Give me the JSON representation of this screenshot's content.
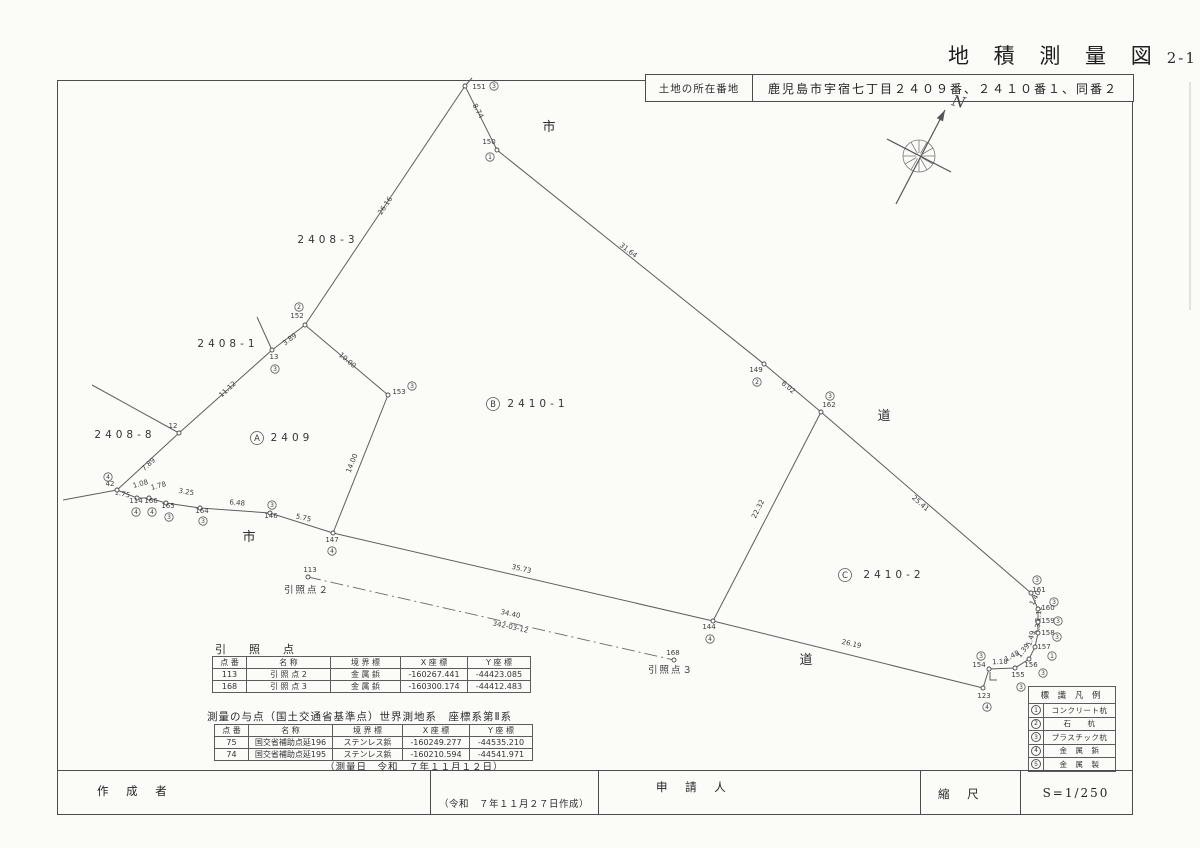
{
  "title": {
    "main": "地 積 測 量 図",
    "sheet": "2-1"
  },
  "address_box": {
    "label": "土地の所在番地",
    "value": "鹿児島市宇宿七丁目２４０９番、２４１０番１、同番２"
  },
  "compass": {
    "cx": 919,
    "cy": 156,
    "r": 16,
    "spokes": 12,
    "arrow": [
      [
        896,
        204
      ],
      [
        945,
        110
      ]
    ],
    "cross": [
      [
        887,
        139
      ],
      [
        951,
        172
      ]
    ],
    "label": "N",
    "lx": 951,
    "ly": 105
  },
  "map": {
    "road_labels": [
      {
        "t": "市",
        "x": 549,
        "y": 131
      },
      {
        "t": "市",
        "x": 249,
        "y": 541
      },
      {
        "t": "道",
        "x": 884,
        "y": 420
      },
      {
        "t": "道",
        "x": 806,
        "y": 664
      }
    ],
    "parcel_labels": [
      {
        "t": "2408-3",
        "x": 328,
        "y": 243
      },
      {
        "t": "2408-1",
        "x": 228,
        "y": 347
      },
      {
        "t": "2408-8",
        "x": 125,
        "y": 438
      },
      {
        "t": "2409",
        "x": 292,
        "y": 441,
        "letter": "A",
        "cx": 257,
        "cy": 438
      },
      {
        "t": "2410-1",
        "x": 538,
        "y": 407,
        "letter": "B",
        "cx": 493,
        "cy": 404
      },
      {
        "t": "2410-2",
        "x": 894,
        "y": 578,
        "letter": "C",
        "cx": 845,
        "cy": 575
      }
    ],
    "ref_labels": [
      {
        "t": "引照点２",
        "x": 307,
        "y": 593
      },
      {
        "t": "引照点３",
        "x": 671,
        "y": 673
      }
    ],
    "lines": [
      [
        [
          472,
          78
        ],
        [
          465,
          86
        ]
      ],
      [
        [
          465,
          86
        ],
        [
          497,
          150
        ]
      ],
      [
        [
          497,
          150
        ],
        [
          764,
          364
        ]
      ],
      [
        [
          764,
          364
        ],
        [
          821,
          412
        ]
      ],
      [
        [
          821,
          412
        ],
        [
          1031,
          593
        ]
      ],
      [
        [
          1031,
          593
        ],
        [
          1038,
          609
        ],
        [
          1038,
          622
        ],
        [
          1038,
          633
        ],
        [
          1035,
          647
        ],
        [
          1029,
          659
        ],
        [
          1015,
          668
        ],
        [
          989,
          669
        ]
      ],
      [
        [
          989,
          669
        ],
        [
          983,
          688
        ]
      ],
      [
        [
          983,
          688
        ],
        [
          713,
          621
        ]
      ],
      [
        [
          713,
          621
        ],
        [
          333,
          533
        ]
      ],
      [
        [
          333,
          533
        ],
        [
          270,
          513
        ],
        [
          200,
          508
        ],
        [
          166,
          503
        ],
        [
          149,
          498
        ],
        [
          137,
          498
        ],
        [
          117,
          490
        ]
      ],
      [
        [
          117,
          490
        ],
        [
          63,
          500
        ]
      ],
      [
        [
          117,
          490
        ],
        [
          179,
          433
        ]
      ],
      [
        [
          179,
          433
        ],
        [
          92,
          385
        ]
      ],
      [
        [
          179,
          433
        ],
        [
          272,
          350
        ]
      ],
      [
        [
          272,
          350
        ],
        [
          305,
          325
        ]
      ],
      [
        [
          272,
          350
        ],
        [
          257,
          317
        ]
      ],
      [
        [
          305,
          325
        ],
        [
          465,
          86
        ]
      ],
      [
        [
          305,
          325
        ],
        [
          388,
          395
        ]
      ],
      [
        [
          388,
          395
        ],
        [
          333,
          533
        ]
      ],
      [
        [
          821,
          412
        ],
        [
          713,
          621
        ]
      ],
      [
        [
          990,
          672
        ],
        [
          990,
          680
        ],
        [
          997,
          680
        ]
      ]
    ],
    "dashed_lines": [
      [
        [
          308,
          577
        ],
        [
          674,
          660
        ]
      ]
    ],
    "faint_lines": [
      [
        [
          1190,
          82
        ],
        [
          1190,
          310
        ]
      ]
    ],
    "length_labels": [
      {
        "t": "8.74",
        "x": 476,
        "y": 112,
        "r": 62
      },
      {
        "t": "26.16",
        "x": 387,
        "y": 207,
        "r": -56
      },
      {
        "t": "31.64",
        "x": 627,
        "y": 252,
        "r": 38
      },
      {
        "t": "6.02",
        "x": 787,
        "y": 389,
        "r": 40
      },
      {
        "t": "25.41",
        "x": 919,
        "y": 505,
        "r": 41
      },
      {
        "t": "22.32",
        "x": 760,
        "y": 510,
        "r": -63
      },
      {
        "t": "10.00",
        "x": 346,
        "y": 362,
        "r": 40
      },
      {
        "t": "3.89",
        "x": 291,
        "y": 341,
        "r": -37
      },
      {
        "t": "11.12",
        "x": 229,
        "y": 391,
        "r": -42
      },
      {
        "t": "7.89",
        "x": 150,
        "y": 466,
        "r": -43
      },
      {
        "t": "14.00",
        "x": 354,
        "y": 464,
        "r": -68
      },
      {
        "t": "1.75",
        "x": 122,
        "y": 496,
        "r": 12
      },
      {
        "t": "1.08",
        "x": 141,
        "y": 486,
        "r": -15
      },
      {
        "t": "1.78",
        "x": 159,
        "y": 488,
        "r": -15
      },
      {
        "t": "3.25",
        "x": 186,
        "y": 494,
        "r": 9
      },
      {
        "t": "6.48",
        "x": 237,
        "y": 505,
        "r": 5
      },
      {
        "t": "5.75",
        "x": 303,
        "y": 520,
        "r": 13
      },
      {
        "t": "35.73",
        "x": 521,
        "y": 571,
        "r": 13
      },
      {
        "t": "26.19",
        "x": 851,
        "y": 646,
        "r": 13
      },
      {
        "t": "34.40",
        "x": 510,
        "y": 616,
        "r": 12
      },
      {
        "t": "342-03-12",
        "x": 510,
        "y": 629,
        "r": 12
      },
      {
        "t": "1.18",
        "x": 1000,
        "y": 664,
        "r": -2
      },
      {
        "t": "1.48",
        "x": 1013,
        "y": 658,
        "r": -28
      },
      {
        "t": "1.39",
        "x": 1025,
        "y": 652,
        "r": -52
      },
      {
        "t": "1.49",
        "x": 1033,
        "y": 639,
        "r": -74
      },
      {
        "t": "0.35",
        "x": 1040,
        "y": 627,
        "r": -86
      },
      {
        "t": "1.12",
        "x": 1041,
        "y": 614,
        "r": -84
      },
      {
        "t": "1.40",
        "x": 1037,
        "y": 599,
        "r": -62
      }
    ],
    "points": [
      {
        "id": "151",
        "x": 465,
        "y": 86,
        "lx": 479,
        "ly": 89,
        "m": "3",
        "mx": 494,
        "my": 86
      },
      {
        "id": "150",
        "x": 497,
        "y": 150,
        "lx": 489,
        "ly": 144,
        "m": "1",
        "mx": 490,
        "my": 157
      },
      {
        "id": "152",
        "x": 305,
        "y": 325,
        "lx": 297,
        "ly": 318,
        "m": "2",
        "mx": 299,
        "my": 307
      },
      {
        "id": "13",
        "x": 272,
        "y": 350,
        "lx": 274,
        "ly": 359,
        "m": "3",
        "mx": 275,
        "my": 369
      },
      {
        "id": "153",
        "x": 388,
        "y": 395,
        "lx": 399,
        "ly": 394,
        "m": "3",
        "mx": 412,
        "my": 386
      },
      {
        "id": "12",
        "x": 179,
        "y": 433,
        "lx": 173,
        "ly": 428
      },
      {
        "id": "42",
        "x": 117,
        "y": 490,
        "lx": 110,
        "ly": 486,
        "m": "4",
        "mx": 108,
        "my": 477
      },
      {
        "id": "114",
        "x": 137,
        "y": 498,
        "lx": 136,
        "ly": 503,
        "m": "4",
        "mx": 136,
        "my": 512
      },
      {
        "id": "166",
        "x": 149,
        "y": 498,
        "lx": 151,
        "ly": 503,
        "m": "4",
        "mx": 152,
        "my": 512
      },
      {
        "id": "165",
        "x": 166,
        "y": 503,
        "lx": 168,
        "ly": 508,
        "m": "3",
        "mx": 169,
        "my": 517
      },
      {
        "id": "164",
        "x": 200,
        "y": 508,
        "lx": 202,
        "ly": 513,
        "m": "3",
        "mx": 203,
        "my": 521
      },
      {
        "id": "146",
        "x": 270,
        "y": 513,
        "lx": 271,
        "ly": 518,
        "m": "3",
        "mx": 272,
        "my": 505
      },
      {
        "id": "147",
        "x": 333,
        "y": 533,
        "lx": 332,
        "ly": 542,
        "m": "4",
        "mx": 332,
        "my": 551
      },
      {
        "id": "113",
        "x": 308,
        "y": 577,
        "lx": 310,
        "ly": 572
      },
      {
        "id": "168",
        "x": 674,
        "y": 660,
        "lx": 673,
        "ly": 655
      },
      {
        "id": "144",
        "x": 713,
        "y": 621,
        "lx": 709,
        "ly": 629,
        "m": "4",
        "mx": 710,
        "my": 639
      },
      {
        "id": "149",
        "x": 764,
        "y": 364,
        "lx": 756,
        "ly": 372,
        "m": "2",
        "mx": 757,
        "my": 382
      },
      {
        "id": "162",
        "x": 821,
        "y": 412,
        "lx": 829,
        "ly": 407,
        "m": "3",
        "mx": 830,
        "my": 396
      },
      {
        "id": "161",
        "x": 1031,
        "y": 593,
        "lx": 1039,
        "ly": 592,
        "m": "3",
        "mx": 1037,
        "my": 580
      },
      {
        "id": "160",
        "x": 1038,
        "y": 609,
        "lx": 1048,
        "ly": 610,
        "m": "3",
        "mx": 1054,
        "my": 602
      },
      {
        "id": "159",
        "x": 1038,
        "y": 622,
        "lx": 1048,
        "ly": 623,
        "m": "3",
        "mx": 1058,
        "my": 621
      },
      {
        "id": "158",
        "x": 1038,
        "y": 633,
        "lx": 1048,
        "ly": 635,
        "m": "3",
        "mx": 1057,
        "my": 637
      },
      {
        "id": "157",
        "x": 1035,
        "y": 647,
        "lx": 1044,
        "ly": 649,
        "m": "1",
        "mx": 1052,
        "my": 656
      },
      {
        "id": "156",
        "x": 1029,
        "y": 659,
        "lx": 1031,
        "ly": 667,
        "m": "3",
        "mx": 1043,
        "my": 673
      },
      {
        "id": "155",
        "x": 1015,
        "y": 668,
        "lx": 1018,
        "ly": 677,
        "m": "3",
        "mx": 1021,
        "my": 687
      },
      {
        "id": "154",
        "x": 989,
        "y": 669,
        "lx": 979,
        "ly": 667,
        "m": "3",
        "mx": 981,
        "my": 656
      },
      {
        "id": "123",
        "x": 983,
        "y": 688,
        "lx": 984,
        "ly": 698,
        "m": "4",
        "mx": 987,
        "my": 707
      }
    ]
  },
  "tables": {
    "t1": {
      "heading": "引　照　点",
      "headers": [
        "点 番",
        "名 称",
        "境 界 標",
        "X 座 標",
        "Y 座 標"
      ],
      "rows": [
        {
          "c": [
            "113",
            "引 照 点 2",
            "金 属 鋲",
            "-160267.441",
            "-44423.085"
          ]
        },
        {
          "c": [
            "168",
            "引 照 点 3",
            "金 属 鋲",
            "-160300.174",
            "-44412.483"
          ]
        }
      ]
    },
    "t2": {
      "heading": "測量の与点（国土交通省基準点）世界測地系　座標系第Ⅱ系",
      "headers": [
        "点 番",
        "名 称",
        "境 界 標",
        "X 座 標",
        "Y 座 標"
      ],
      "rows": [
        {
          "c": [
            "75",
            "国交省補助点延196",
            "ステンレス鋲",
            "-160249.277",
            "-44535.210"
          ]
        },
        {
          "c": [
            "74",
            "国交省補助点延195",
            "ステンレス鋲",
            "-160210.594",
            "-44541.971"
          ]
        }
      ],
      "date_note": "（測量日　令和　７年１１月１２日）"
    }
  },
  "legend": {
    "title": "標 識 凡 例",
    "rows": [
      {
        "n": "1",
        "t": "コンクリート杭"
      },
      {
        "n": "2",
        "t": "石　　杭"
      },
      {
        "n": "3",
        "t": "プラスチック杭"
      },
      {
        "n": "4",
        "t": "金　属　鋲"
      },
      {
        "n": "5",
        "t": "金　属　製"
      }
    ]
  },
  "footer": {
    "author_label": "作 成 者",
    "created_note": "（令和　７年１１月２７日作成）",
    "applicant_label": "申 請 人",
    "scale_label": "縮 尺",
    "scale_value": "S=1/250"
  }
}
